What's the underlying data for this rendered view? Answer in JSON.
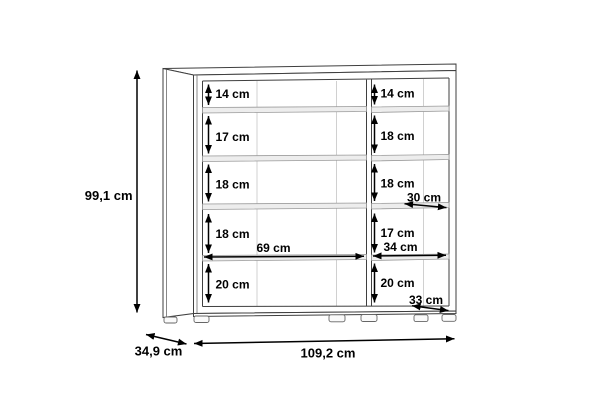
{
  "diagram": {
    "type": "furniture-dimension-drawing",
    "overall": {
      "height": "99,1 cm",
      "depth": "34,9 cm",
      "width": "109,2 cm"
    },
    "left_section": {
      "gaps": [
        "14 cm",
        "17 cm",
        "18 cm",
        "18 cm",
        "20 cm"
      ],
      "inner_width": "69 cm"
    },
    "right_section": {
      "gaps": [
        "14 cm",
        "18 cm",
        "18 cm",
        "17 cm",
        "20 cm"
      ],
      "inner_width": "34 cm",
      "upper_shelf_depth": "30 cm",
      "lower_shelf_depth": "33 cm"
    },
    "colors": {
      "background": "#ffffff",
      "structure_line": "#3f3f3f",
      "dimension_line": "#000000",
      "shelf_fill": "#ededed",
      "seam_line": "#d0d0d0"
    }
  }
}
